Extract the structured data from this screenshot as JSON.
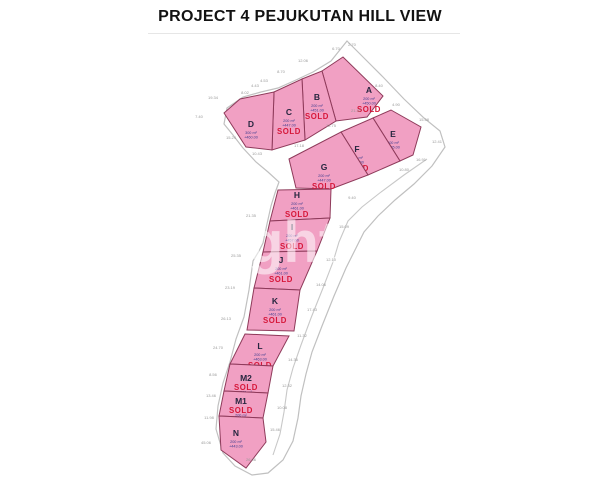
{
  "title": "PROJECT 4 PEJUKUTAN HILL VIEW",
  "watermark": "ght",
  "map": {
    "background": "#ffffff",
    "boundary_color": "#c0c0c0",
    "road_color": "#c8c8c8",
    "plot_fill": "#f1a0c3",
    "plot_stroke": "#8e3a5a",
    "letter_color": "#26263f",
    "detail_color": "#3d3d8f",
    "sold_color": "#d6173a",
    "dim_color": "#999999",
    "watermark_color": "#ffffff",
    "outer_boundary": [
      [
        347,
        41
      ],
      [
        362,
        56
      ],
      [
        383,
        77
      ],
      [
        404,
        99
      ],
      [
        424,
        118
      ],
      [
        440,
        131
      ],
      [
        445,
        147
      ],
      [
        432,
        166
      ],
      [
        414,
        184
      ],
      [
        395,
        200
      ],
      [
        378,
        216
      ],
      [
        364,
        232
      ],
      [
        355,
        250
      ],
      [
        346,
        268
      ],
      [
        334,
        296
      ],
      [
        322,
        326
      ],
      [
        312,
        352
      ],
      [
        306,
        374
      ],
      [
        301,
        396
      ],
      [
        298,
        418
      ],
      [
        293,
        441
      ],
      [
        283,
        460
      ],
      [
        268,
        473
      ],
      [
        252,
        475
      ],
      [
        235,
        466
      ],
      [
        223,
        453
      ],
      [
        216,
        429
      ],
      [
        218,
        406
      ],
      [
        223,
        383
      ],
      [
        230,
        362
      ],
      [
        236,
        339
      ],
      [
        244,
        317
      ],
      [
        249,
        290
      ],
      [
        253,
        261
      ],
      [
        259,
        251
      ],
      [
        263,
        243
      ],
      [
        267,
        224
      ],
      [
        271,
        206
      ],
      [
        275,
        193
      ],
      [
        279,
        182
      ],
      [
        268,
        172
      ],
      [
        256,
        162
      ],
      [
        243,
        148
      ],
      [
        233,
        135
      ],
      [
        224,
        124
      ],
      [
        227,
        108
      ],
      [
        243,
        97
      ],
      [
        261,
        92
      ],
      [
        278,
        88
      ],
      [
        296,
        80
      ],
      [
        313,
        72
      ],
      [
        331,
        61
      ]
    ],
    "inner_road": [
      [
        427,
        159
      ],
      [
        404,
        175
      ],
      [
        381,
        192
      ],
      [
        362,
        207
      ],
      [
        348,
        221
      ],
      [
        339,
        242
      ],
      [
        333,
        262
      ],
      [
        323,
        288
      ],
      [
        311,
        318
      ],
      [
        301,
        345
      ],
      [
        293,
        368
      ],
      [
        287,
        390
      ],
      [
        284,
        412
      ],
      [
        280,
        434
      ],
      [
        273,
        455
      ]
    ],
    "plots": [
      {
        "id": "A",
        "area": "200 m²",
        "elevation": "+450.00",
        "sold": true,
        "compact": false,
        "points": [
          [
            322,
            71
          ],
          [
            343,
            57
          ],
          [
            383,
            96
          ],
          [
            367,
            117
          ],
          [
            336,
            121
          ]
        ],
        "lx": 369,
        "ly": 93
      },
      {
        "id": "B",
        "area": "200 m²",
        "elevation": "+451.00",
        "sold": true,
        "compact": false,
        "points": [
          [
            302,
            79
          ],
          [
            322,
            71
          ],
          [
            336,
            121
          ],
          [
            305,
            140
          ]
        ],
        "lx": 317,
        "ly": 100
      },
      {
        "id": "C",
        "area": "200 m²",
        "elevation": "+447.00",
        "sold": true,
        "compact": false,
        "points": [
          [
            274,
            92
          ],
          [
            302,
            79
          ],
          [
            305,
            140
          ],
          [
            272,
            150
          ]
        ],
        "lx": 289,
        "ly": 115
      },
      {
        "id": "D",
        "area": "300 m²",
        "elevation": "+460.00",
        "sold": false,
        "compact": false,
        "points": [
          [
            224,
            113
          ],
          [
            240,
            99
          ],
          [
            274,
            92
          ],
          [
            272,
            150
          ],
          [
            246,
            147
          ]
        ],
        "lx": 251,
        "ly": 127
      },
      {
        "id": "E",
        "area": "200 m²",
        "elevation": "+455.00",
        "sold": false,
        "compact": false,
        "points": [
          [
            373,
            118
          ],
          [
            391,
            110
          ],
          [
            421,
            127
          ],
          [
            413,
            155
          ],
          [
            400,
            161
          ]
        ],
        "lx": 393,
        "ly": 137
      },
      {
        "id": "F",
        "area": "200 m²",
        "elevation": "+451.00",
        "sold": true,
        "compact": false,
        "points": [
          [
            341,
            132
          ],
          [
            373,
            118
          ],
          [
            400,
            161
          ],
          [
            368,
            175
          ]
        ],
        "lx": 357,
        "ly": 152
      },
      {
        "id": "G",
        "area": "200 m²",
        "elevation": "+447.00",
        "sold": true,
        "compact": false,
        "points": [
          [
            289,
            159
          ],
          [
            341,
            132
          ],
          [
            368,
            175
          ],
          [
            331,
            189
          ],
          [
            296,
            188
          ]
        ],
        "lx": 324,
        "ly": 170
      },
      {
        "id": "H",
        "area": "200 m²",
        "elevation": "+461.00",
        "sold": true,
        "compact": false,
        "points": [
          [
            278,
            190
          ],
          [
            331,
            189
          ],
          [
            330,
            218
          ],
          [
            270,
            221
          ]
        ],
        "lx": 297,
        "ly": 198
      },
      {
        "id": "I",
        "area": "200 m²",
        "elevation": "+457.00",
        "sold": true,
        "compact": false,
        "points": [
          [
            270,
            221
          ],
          [
            330,
            218
          ],
          [
            317,
            251
          ],
          [
            263,
            252
          ]
        ],
        "lx": 292,
        "ly": 230
      },
      {
        "id": "J",
        "area": "200 m²",
        "elevation": "+461.00",
        "sold": true,
        "compact": false,
        "points": [
          [
            263,
            252
          ],
          [
            317,
            251
          ],
          [
            300,
            290
          ],
          [
            254,
            288
          ]
        ],
        "lx": 281,
        "ly": 263
      },
      {
        "id": "K",
        "area": "200 m²",
        "elevation": "+461.00",
        "sold": true,
        "compact": false,
        "points": [
          [
            254,
            288
          ],
          [
            300,
            290
          ],
          [
            294,
            331
          ],
          [
            247,
            330
          ]
        ],
        "lx": 275,
        "ly": 304
      },
      {
        "id": "L",
        "area": "200 m²",
        "elevation": "+463.00",
        "sold": true,
        "compact": false,
        "points": [
          [
            245,
            334
          ],
          [
            289,
            336
          ],
          [
            273,
            366
          ],
          [
            230,
            364
          ]
        ],
        "lx": 260,
        "ly": 349
      },
      {
        "id": "M2",
        "area": "200 m²",
        "elevation": "+465.00",
        "sold": true,
        "compact": true,
        "points": [
          [
            230,
            364
          ],
          [
            273,
            366
          ],
          [
            268,
            393
          ],
          [
            224,
            391
          ]
        ],
        "lx": 246,
        "ly": 381
      },
      {
        "id": "M1",
        "area": "200 m²",
        "elevation": "+459.00",
        "sold": true,
        "compact": true,
        "points": [
          [
            224,
            391
          ],
          [
            268,
            393
          ],
          [
            263,
            418
          ],
          [
            219,
            416
          ]
        ],
        "lx": 241,
        "ly": 404
      },
      {
        "id": "N",
        "area": "200 m²",
        "elevation": "+443.00",
        "sold": false,
        "compact": false,
        "points": [
          [
            219,
            416
          ],
          [
            263,
            418
          ],
          [
            266,
            442
          ],
          [
            246,
            468
          ],
          [
            221,
            450
          ]
        ],
        "lx": 236,
        "ly": 436
      }
    ],
    "dimensions": [
      {
        "v": "2.70",
        "x": 352,
        "y": 46
      },
      {
        "v": "6.70",
        "x": 336,
        "y": 50
      },
      {
        "v": "12.06",
        "x": 303,
        "y": 62
      },
      {
        "v": "8.70",
        "x": 281,
        "y": 73
      },
      {
        "v": "4.53",
        "x": 264,
        "y": 82
      },
      {
        "v": "4.43",
        "x": 255,
        "y": 87
      },
      {
        "v": "8.02",
        "x": 245,
        "y": 94
      },
      {
        "v": "19.34",
        "x": 213,
        "y": 99
      },
      {
        "v": "7.40",
        "x": 199,
        "y": 118
      },
      {
        "v": "15.24",
        "x": 231,
        "y": 139
      },
      {
        "v": "10.43",
        "x": 257,
        "y": 155
      },
      {
        "v": "17.18",
        "x": 299,
        "y": 147
      },
      {
        "v": "21.37",
        "x": 356,
        "y": 112
      },
      {
        "v": "12.75",
        "x": 331,
        "y": 127
      },
      {
        "v": "8.40",
        "x": 379,
        "y": 87
      },
      {
        "v": "4.90",
        "x": 396,
        "y": 106
      },
      {
        "v": "15.58",
        "x": 424,
        "y": 121
      },
      {
        "v": "12.41",
        "x": 437,
        "y": 143
      },
      {
        "v": "16.91",
        "x": 421,
        "y": 161
      },
      {
        "v": "10.80",
        "x": 404,
        "y": 171
      },
      {
        "v": "9.40",
        "x": 352,
        "y": 199
      },
      {
        "v": "15.09",
        "x": 344,
        "y": 228
      },
      {
        "v": "21.35",
        "x": 251,
        "y": 217
      },
      {
        "v": "25.35",
        "x": 236,
        "y": 257
      },
      {
        "v": "23.19",
        "x": 230,
        "y": 289
      },
      {
        "v": "26.13",
        "x": 226,
        "y": 320
      },
      {
        "v": "24.70",
        "x": 218,
        "y": 349
      },
      {
        "v": "8.56",
        "x": 213,
        "y": 376
      },
      {
        "v": "13.46",
        "x": 211,
        "y": 397
      },
      {
        "v": "11.98",
        "x": 209,
        "y": 419
      },
      {
        "v": "45.06",
        "x": 206,
        "y": 444
      },
      {
        "v": "26.06",
        "x": 251,
        "y": 461
      },
      {
        "v": "15.46",
        "x": 275,
        "y": 431
      },
      {
        "v": "10.08",
        "x": 282,
        "y": 409
      },
      {
        "v": "12.32",
        "x": 287,
        "y": 387
      },
      {
        "v": "14.36",
        "x": 293,
        "y": 361
      },
      {
        "v": "11.32",
        "x": 302,
        "y": 337
      },
      {
        "v": "17.43",
        "x": 312,
        "y": 311
      },
      {
        "v": "14.06",
        "x": 321,
        "y": 286
      },
      {
        "v": "12.10",
        "x": 331,
        "y": 261
      }
    ]
  }
}
